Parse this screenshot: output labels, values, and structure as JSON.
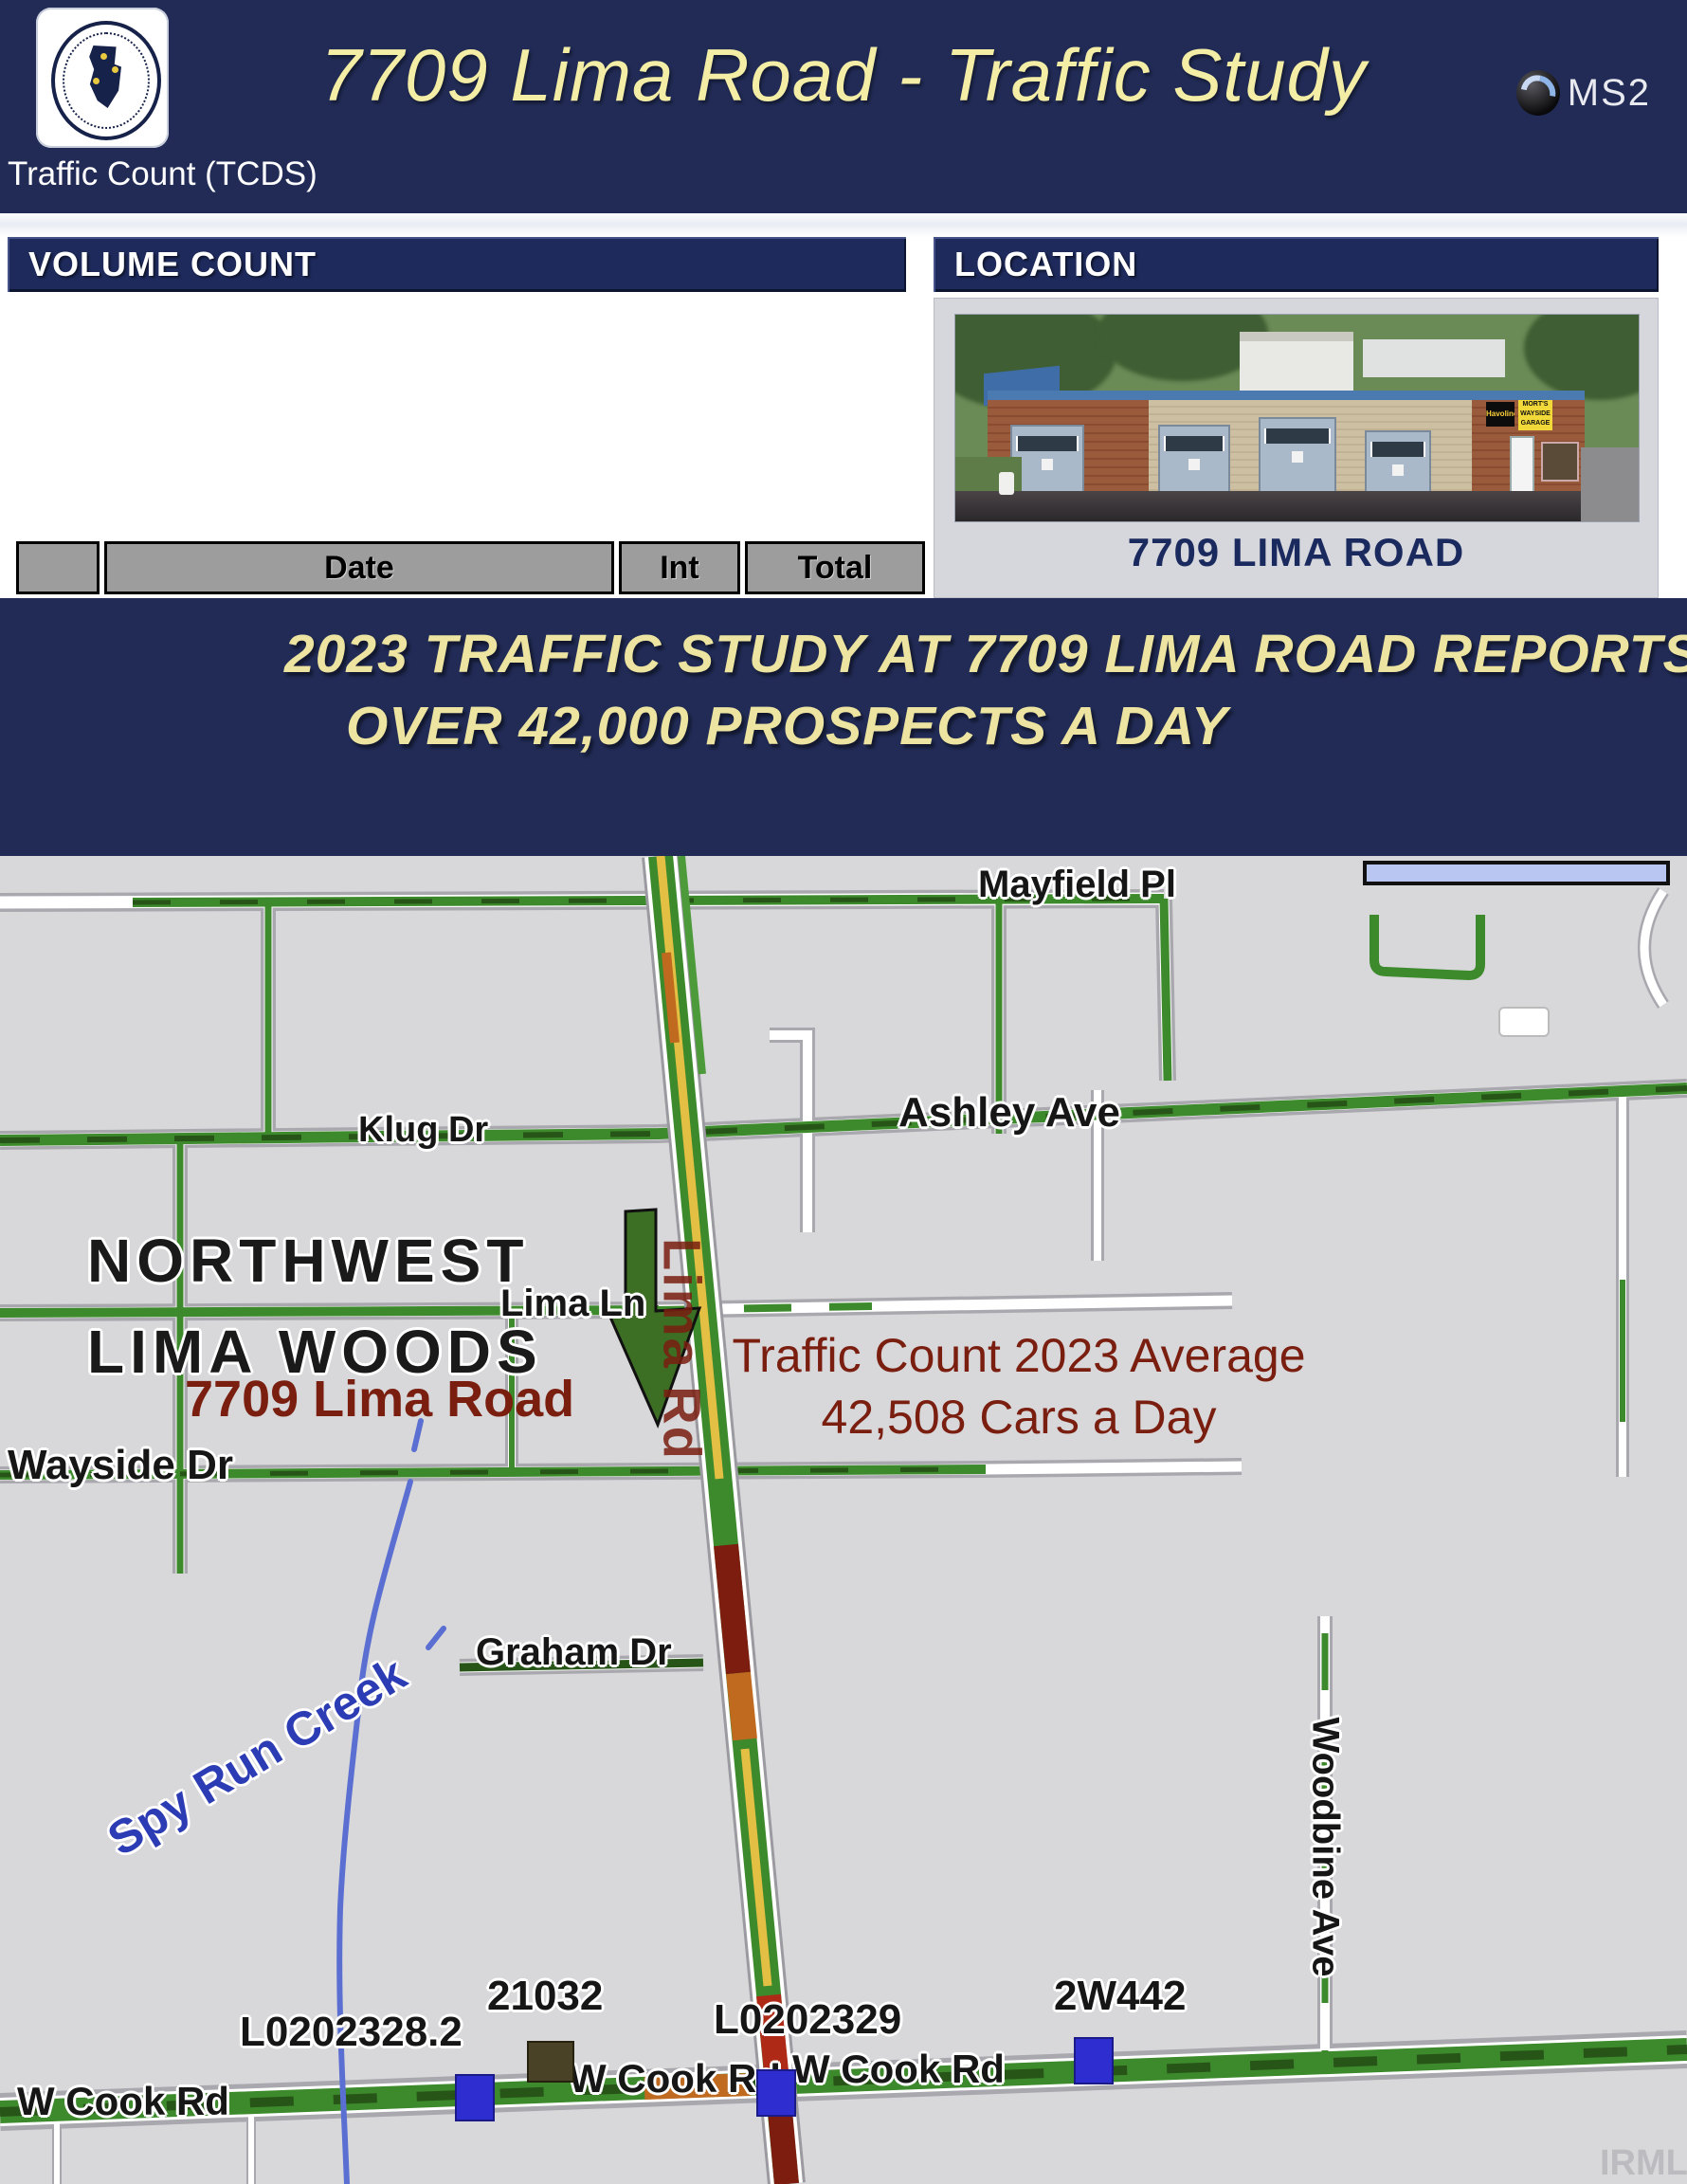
{
  "header": {
    "title": "7709 Lima Road - Traffic Study",
    "tcds_label": "Traffic Count (TCDS)",
    "ms2_label": "MS2"
  },
  "volume_count": {
    "panel_title": "VOLUME COUNT",
    "columns": {
      "date": "Date",
      "int": "Int",
      "total": "Total"
    },
    "rows": [
      {
        "date": "Wed 8/9/2023",
        "int": "15",
        "total": "42,585"
      },
      {
        "date": "Tue 8/8/2023",
        "int": "15",
        "total": "42,432"
      },
      {
        "date": "Wed 8/19/2020",
        "int": "15",
        "total": "40,866"
      },
      {
        "date": "Tue 8/18/2020",
        "int": "15",
        "total": "40,668"
      }
    ]
  },
  "location": {
    "panel_title": "LOCATION",
    "caption": "7709 LIMA ROAD",
    "photo": {
      "sign_black": "Havoline",
      "sign_yellow": "MORT'S WAYSIDE GARAGE"
    }
  },
  "banner": {
    "line1": "2023 TRAFFIC STUDY AT 7709 LIMA ROAD REPORTS",
    "line2": "OVER 42,000 PROSPECTS A DAY"
  },
  "map": {
    "area": {
      "line1": "NORTHWEST",
      "line2": "LIMA WOODS"
    },
    "streets": {
      "mayfield": "Mayfield Pl",
      "klug": "Klug Dr",
      "ashley": "Ashley Ave",
      "lima_ln": "Lima Ln",
      "wayside": "Wayside Dr",
      "graham": "Graham Dr",
      "cook_left": "W Cook Rd",
      "cook_mid": "W Cook Rd",
      "cook_right": "W Cook Rd",
      "woodbine": "Woodbine Ave",
      "lima_rd": "Lima Rd"
    },
    "poi": "7709 Lima Road",
    "note_line1": "Traffic Count 2023 Average",
    "note_line2": "42,508 Cars a Day",
    "stations": {
      "s1": "L0202328.2",
      "s2": "21032",
      "s3": "L0202329",
      "s4": "2W442"
    },
    "creek": "Spy Run Creek",
    "watermark": "IRMLS"
  },
  "colors": {
    "header_navy": "#212b55",
    "title_yellow": "#f3eda6",
    "banner_yellow": "#ece4a0",
    "table_header_gray": "#9d9d9d",
    "table_row_cream": "#f8f8e9",
    "map_bg": "#d8d8da",
    "road_green": "#3d8a2c",
    "road_yellow": "#e3bf43",
    "road_orange": "#bf6a1e",
    "road_red": "#ae2a16",
    "road_maroon": "#7c1d10",
    "creek_blue": "#5b6fd2",
    "label_maroon": "#7a1e10",
    "marker_blue": "#2d2dd0"
  }
}
